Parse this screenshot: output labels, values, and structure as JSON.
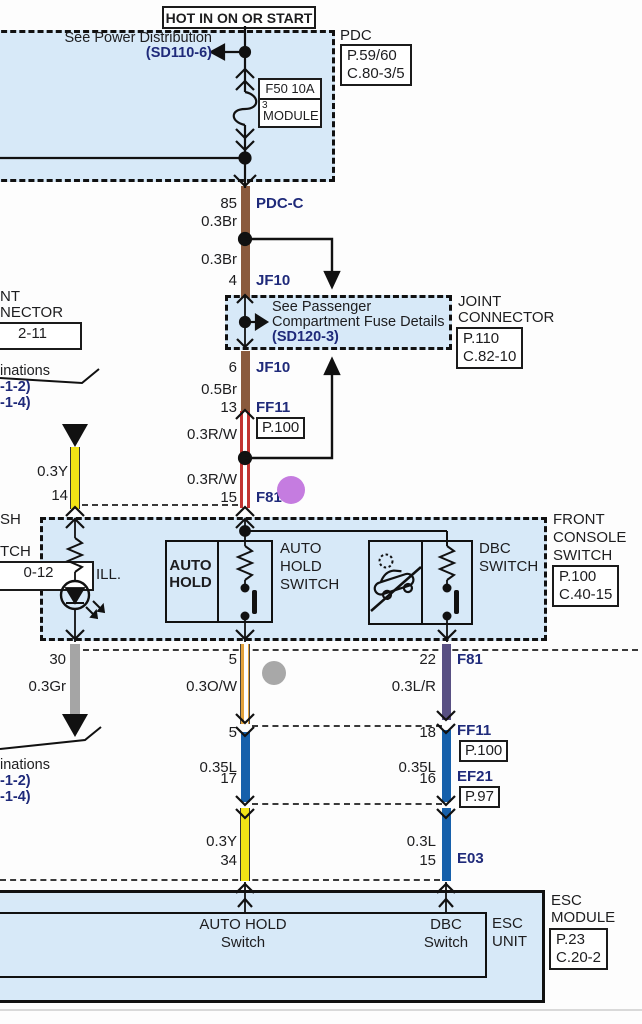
{
  "colors": {
    "diagram_box_fill": "#d7e9f8",
    "navy_link": "#1f2a7a",
    "wire_brown": "#8a5a3d",
    "wire_red": "#c23431",
    "wire_yellow": "#f2e316",
    "wire_orange": "#e2a23c",
    "wire_gray": "#a5a5a5",
    "wire_blue": "#1660ab",
    "wire_blue_red": "#585083",
    "annotation_purple": "#c57ce0",
    "annotation_gray": "#a8a8a8"
  },
  "header": {
    "hot": "HOT IN ON OR START",
    "see_power": "See Power Distribution",
    "sd110": "(SD110-6)",
    "pdc": "PDC",
    "pdc_page": "P.59/60",
    "pdc_conn": "C.80-3/5",
    "fuse_name": "F50 10A",
    "fuse_num": "3",
    "fuse_owner": "MODULE"
  },
  "center": {
    "pin85": "85",
    "pdc_c": "PDC-C",
    "br_a": "0.3Br",
    "br_b": "0.3Br",
    "pin4": "4",
    "jf10_a": "JF10",
    "joint_see1": "See Passenger",
    "joint_see2": "Compartment Fuse Details",
    "joint_sd120": "(SD120-3)",
    "pin6": "6",
    "jf10_b": "JF10",
    "br05": "0.5Br",
    "pin13": "13",
    "ff11": "FF11",
    "ff11_page": "P.100",
    "rw_a": "0.3R/W",
    "rw_b": "0.3R/W",
    "pin15": "15",
    "f81": "F81"
  },
  "joint_label": {
    "l1": "JOINT",
    "l2": "CONNECTOR",
    "page": "P.110",
    "conn": "C.82-10"
  },
  "left_top": {
    "l1": "NT",
    "l2": "NECTOR",
    "ref": "2-11",
    "ill": "inations",
    "sd_a": "-1-2)",
    "sd_b": "-1-4)"
  },
  "left_mid": {
    "wire_y": "0.3Y",
    "pin14": "14",
    "l1": "SH",
    "l2": "TCH",
    "ref": "0-12",
    "pin30": "30",
    "wire_gr": "0.3Gr"
  },
  "console": {
    "ill": "ILL.",
    "btn_l1": "AUTO",
    "btn_l2": "HOLD",
    "ah_l1": "AUTO",
    "ah_l2": "HOLD",
    "ah_l3": "SWITCH",
    "dbc_l1": "DBC",
    "dbc_l2": "SWITCH",
    "name_l1": "FRONT",
    "name_l2": "CONSOLE",
    "name_l3": "SWITCH",
    "page": "P.100",
    "conn": "C.40-15"
  },
  "lower": {
    "pin5a": "5",
    "wire_ow": "0.3O/W",
    "pin5b": "5",
    "wire_l35a": "0.35L",
    "pin17": "17",
    "wire_y": "0.3Y",
    "pin34": "34",
    "pin22": "22",
    "f81": "F81",
    "wire_lr": "0.3L/R",
    "pin18": "18",
    "ff11": "FF11",
    "ff11_page": "P.100",
    "wire_l35b": "0.35L",
    "pin16": "16",
    "ef21": "EF21",
    "ef21_page": "P.97",
    "wire_l03": "0.3L",
    "pin15": "15",
    "e03": "E03",
    "ill": "inations",
    "sd_a": "-1-2)",
    "sd_b": "-1-4)"
  },
  "esc": {
    "ah_l1": "AUTO HOLD",
    "ah_l2": "Switch",
    "dbc_l1": "DBC",
    "dbc_l2": "Switch",
    "unit_l1": "ESC",
    "unit_l2": "UNIT",
    "name_l1": "ESC",
    "name_l2": "MODULE",
    "page": "P.23",
    "conn": "C.20-2"
  }
}
